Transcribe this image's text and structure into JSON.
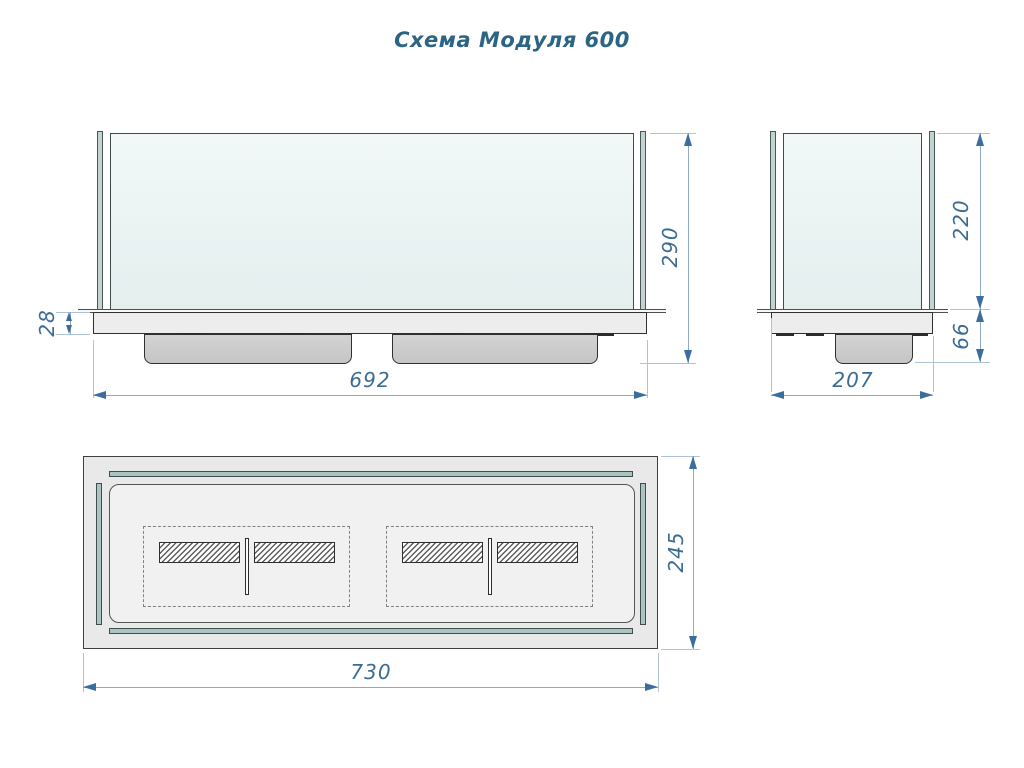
{
  "title": "Схема Модуля 600",
  "views": {
    "front": {
      "width": "692",
      "height": "290",
      "base_height": "28"
    },
    "side": {
      "width": "207",
      "glass_height": "220",
      "under_height": "66"
    },
    "top": {
      "width": "730",
      "depth": "245"
    }
  },
  "icons": {
    "dimension_arrow": "filled-triangle"
  },
  "colors": {
    "dimension_text": "#3c6c94",
    "title_text": "#2c6484",
    "dimension_line": "#8fa9c6",
    "part_outline": "#383838",
    "glass_fill": "#eaf2f1",
    "glass_edge_fill": "#c2d4d2",
    "glass_strip_fill": "#a9c4c1",
    "tank_fill": "#cccccc",
    "base_fill": "#ededed"
  }
}
